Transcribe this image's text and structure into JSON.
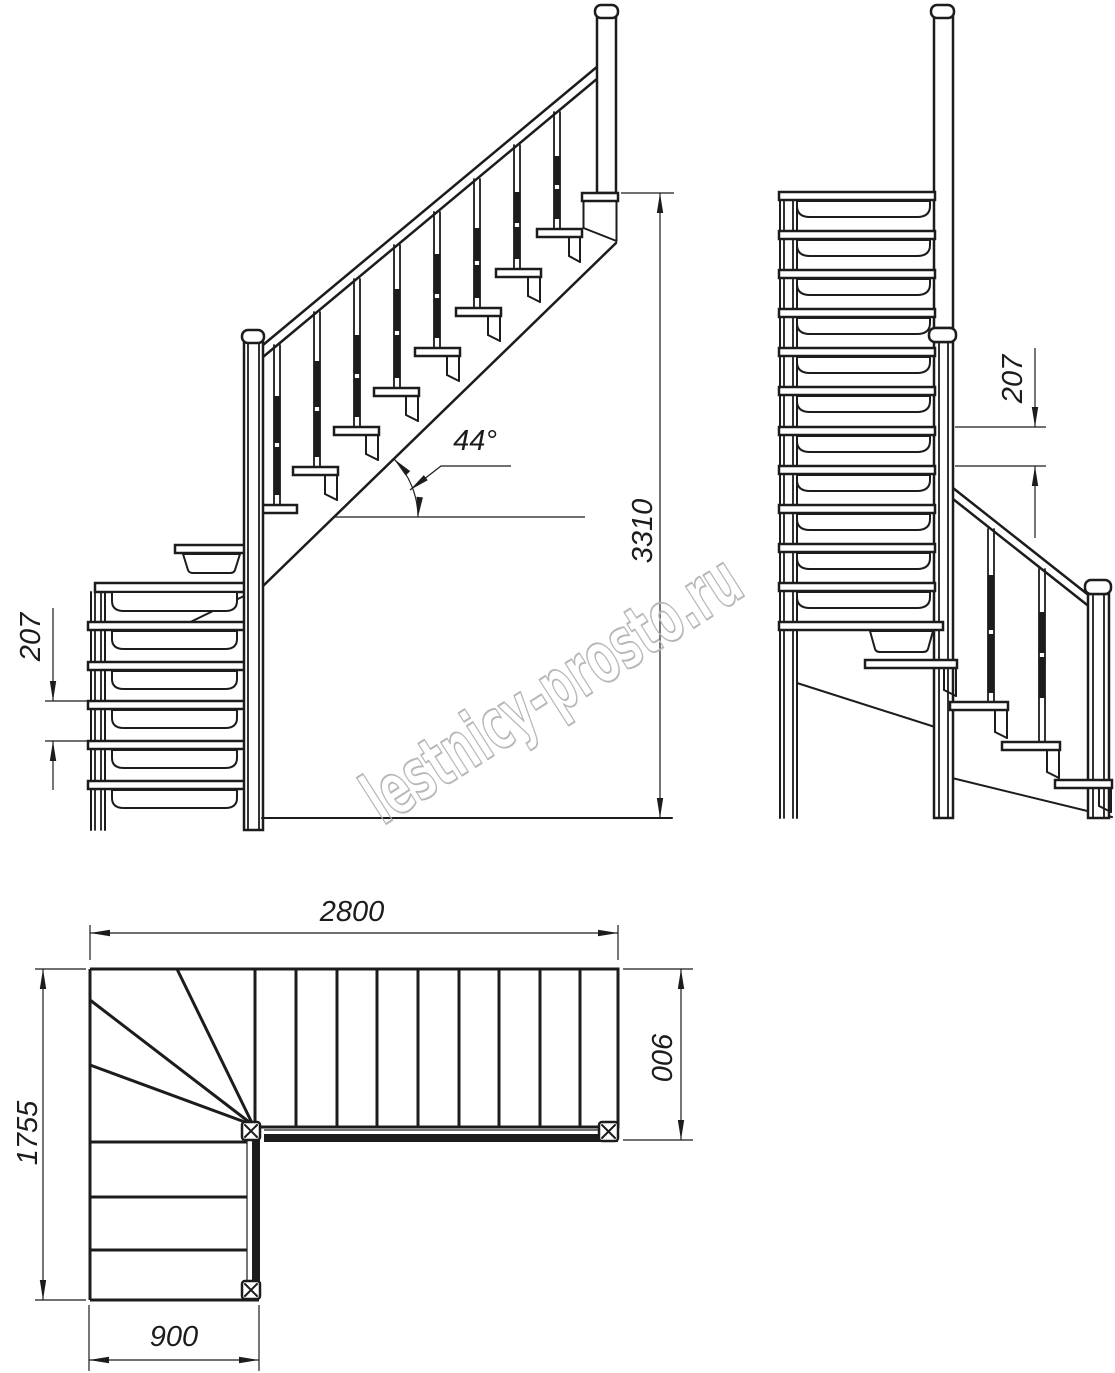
{
  "watermark": {
    "text": "lestnicy-prosto.ru"
  },
  "colors": {
    "line": "#1c1c1c",
    "watermark_outline": "#b4b4b4",
    "background": "#ffffff"
  },
  "views": {
    "front_elevation": {
      "angle_label": "44°",
      "total_height_mm": "3310",
      "riser_height_mm": "207"
    },
    "side_elevation": {
      "riser_height_mm": "207"
    },
    "plan": {
      "upper_flight_length_mm": "2800",
      "upper_flight_width_mm": "900",
      "total_depth_mm": "1755",
      "lower_flight_width_mm": "900"
    }
  }
}
